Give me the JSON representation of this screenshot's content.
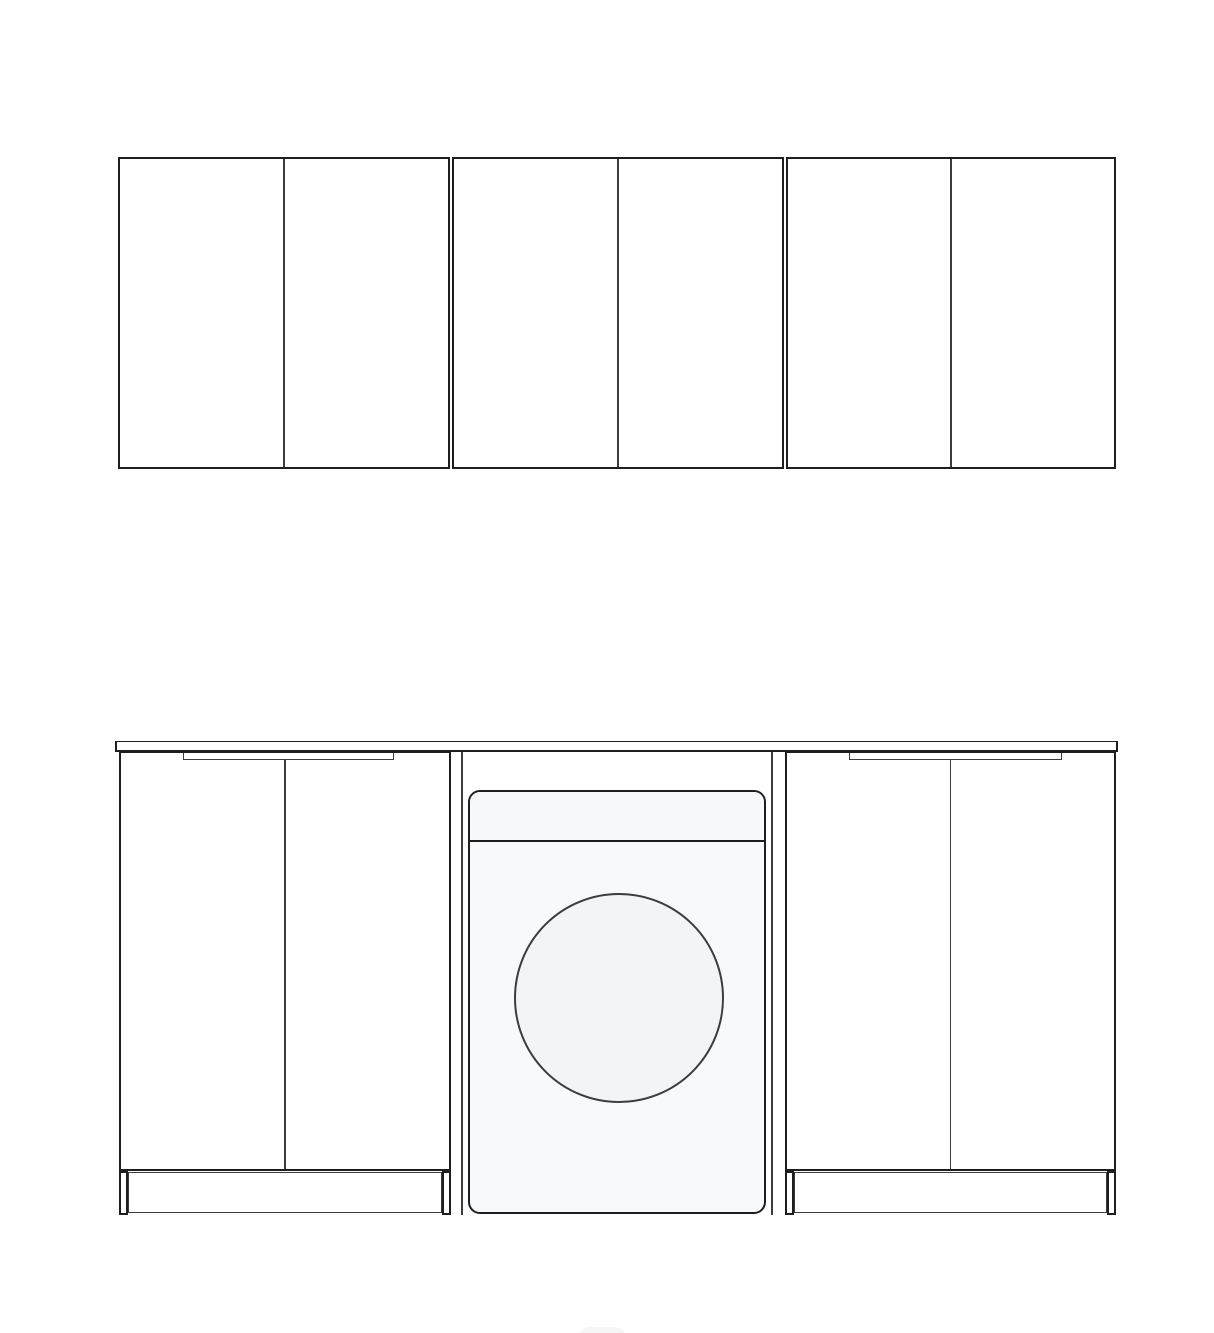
{
  "colors": {
    "background": "#ffffff",
    "line_strong": "#1e1e1e",
    "line_light": "#3c3c3c",
    "appliance_fill": "#f7f9fb",
    "appliance_panel_fill": "#f6f8fa",
    "drum_fill": "#f3f4f6",
    "cabinet_fill": "#ffffff"
  },
  "scene": {
    "name": "kitchen-cabinet-elevation",
    "wall_cabinets": [
      {
        "id": "wall-cabinet-left",
        "doors": 2
      },
      {
        "id": "wall-cabinet-center",
        "doors": 2
      },
      {
        "id": "wall-cabinet-right",
        "doors": 2
      }
    ],
    "countertop": {
      "present": true
    },
    "base_cabinets": [
      {
        "id": "base-cabinet-left",
        "doors": 2,
        "handle_groove": true,
        "plinth": true,
        "plinth_legs": 2
      },
      {
        "id": "base-cabinet-right",
        "doors": 2,
        "handle_groove": true,
        "plinth": true,
        "plinth_legs": 2
      }
    ],
    "appliance": {
      "id": "washing-machine",
      "type": "front-load-washer",
      "parts": [
        "control-panel-band",
        "round-door-drum"
      ]
    }
  }
}
